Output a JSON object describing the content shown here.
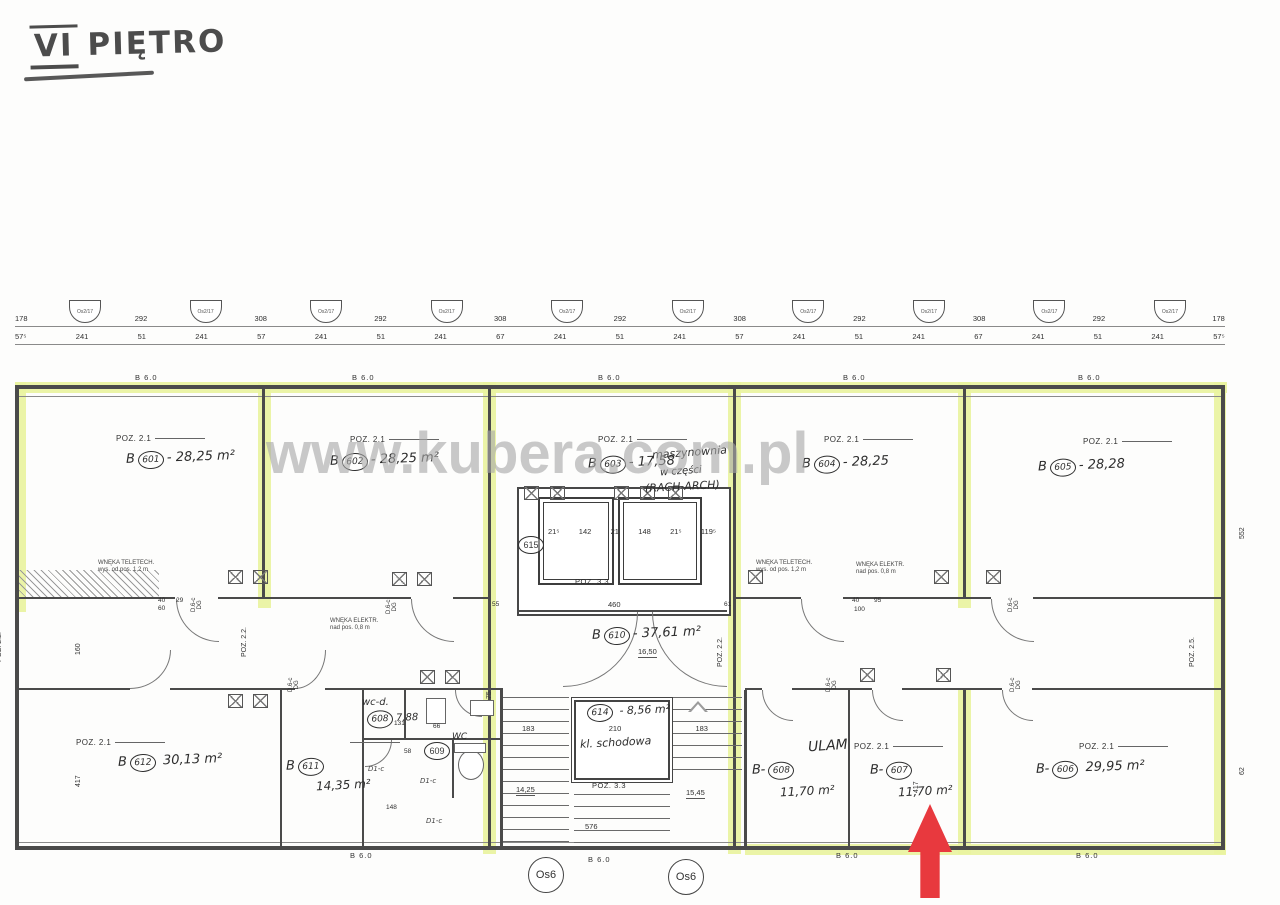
{
  "page": {
    "title_roman": "VI",
    "title_text": "PIĘTRO"
  },
  "watermark": "www.kubera.com.pl",
  "colors": {
    "highlight": "#e9f3a0",
    "arrow_red": "#e8393e",
    "watermark_gray": "#a8a8a8",
    "ink": "#3b3b3b"
  },
  "grid": {
    "bubbles": [
      "Os2/17",
      "Os2/17",
      "Os2/17",
      "Os2/17",
      "Os2/17",
      "Os2/17",
      "Os2/17",
      "Os2/17",
      "Os2/17",
      "Os2/17"
    ],
    "bottom_axis": [
      "Os6",
      "Os6"
    ],
    "dims_row1": [
      "178",
      "292",
      "308",
      "292",
      "308",
      "292",
      "308",
      "292",
      "308",
      "292",
      "178"
    ],
    "dims_row2": [
      "57⁵",
      "241",
      "51",
      "241",
      "57",
      "241",
      "51",
      "241",
      "67",
      "241",
      "51",
      "241",
      "57",
      "241",
      "51",
      "241",
      "67",
      "241",
      "51",
      "241",
      "57⁵"
    ]
  },
  "beam_label": "B 6.0",
  "rooms": {
    "r601": {
      "prefix": "B",
      "num": "601",
      "sep": "-",
      "area": "28,25 m²",
      "poz": "POZ. 2.1"
    },
    "r602": {
      "prefix": "B",
      "num": "602",
      "sep": "-",
      "area": "28,25 m²",
      "poz": "POZ. 2.1"
    },
    "r603": {
      "prefix": "B",
      "num": "603",
      "sep": "-",
      "area": "17,58",
      "poz": "POZ. 2.1",
      "note1": "maszynownia",
      "note2": "w części",
      "note3": "(RACH-ARCH)"
    },
    "r604": {
      "prefix": "B",
      "num": "604",
      "sep": "-",
      "area": "28,25",
      "poz": "POZ. 2.1"
    },
    "r605": {
      "prefix": "B",
      "num": "605",
      "sep": "-",
      "area": "28,28",
      "poz": "POZ. 2.1"
    },
    "r606": {
      "prefix": "B-",
      "num": "606",
      "area": "29,95 m²",
      "poz": "POZ. 2.1"
    },
    "r607": {
      "prefix": "B-",
      "num": "607",
      "area": "11,70 m²",
      "poz": "POZ. 2.1"
    },
    "r608": {
      "prefix": "B-",
      "num": "608",
      "area": "11,70 m²",
      "note": "ULAM"
    },
    "r609": {
      "num": "609",
      "name": "WC"
    },
    "r610": {
      "prefix": "B",
      "num": "610",
      "sep": "-",
      "area": "37,61 m²",
      "level": "16,50"
    },
    "r611": {
      "prefix": "B",
      "num": "611",
      "area": "14,35 m²"
    },
    "r612": {
      "prefix": "B",
      "num": "612",
      "area": "30,13 m²",
      "poz": "POZ. 2.1"
    },
    "r614": {
      "num": "614",
      "sep": "-",
      "area": "8,56 m²",
      "name": "kl. schodowa"
    },
    "r615": {
      "num": "615"
    },
    "wc_d": {
      "name": "wc-d.",
      "num": "608",
      "area": "7,88"
    }
  },
  "stairs": {
    "dims": [
      "183",
      "210",
      "183"
    ],
    "poz": "POZ. 3.3",
    "level_left": "14,25",
    "level_right": "15,45",
    "dim_bottom": "576"
  },
  "elevators": {
    "dims": [
      "21⁵",
      "142",
      "21",
      "148",
      "21⁵",
      "119⁵"
    ],
    "poz": "POZ. 3.3",
    "dim_bottom": "460"
  },
  "ann": {
    "poz22": "POZ. 2.2.",
    "poz25": "POZ. 2.5.",
    "nook1a": "WNĘKA TELETECH.",
    "nook1b": "wys. od pos. 1,2 m",
    "nook2a": "WNĘKA ELEKTR.",
    "nook2b": "nad pos. 0,8 m",
    "door_v1": "D.6-c",
    "door_v2": "DG",
    "d1c": "D1-c",
    "n40": "40",
    "n60": "60",
    "n29": "29",
    "n95": "95",
    "n100": "100",
    "n61": "61",
    "n55": "55",
    "n131": "131",
    "n148": "148",
    "n58": "58",
    "n66": "66",
    "v417": "417",
    "v160": "160",
    "v552": "552",
    "v62": "62",
    "v75": "75"
  }
}
